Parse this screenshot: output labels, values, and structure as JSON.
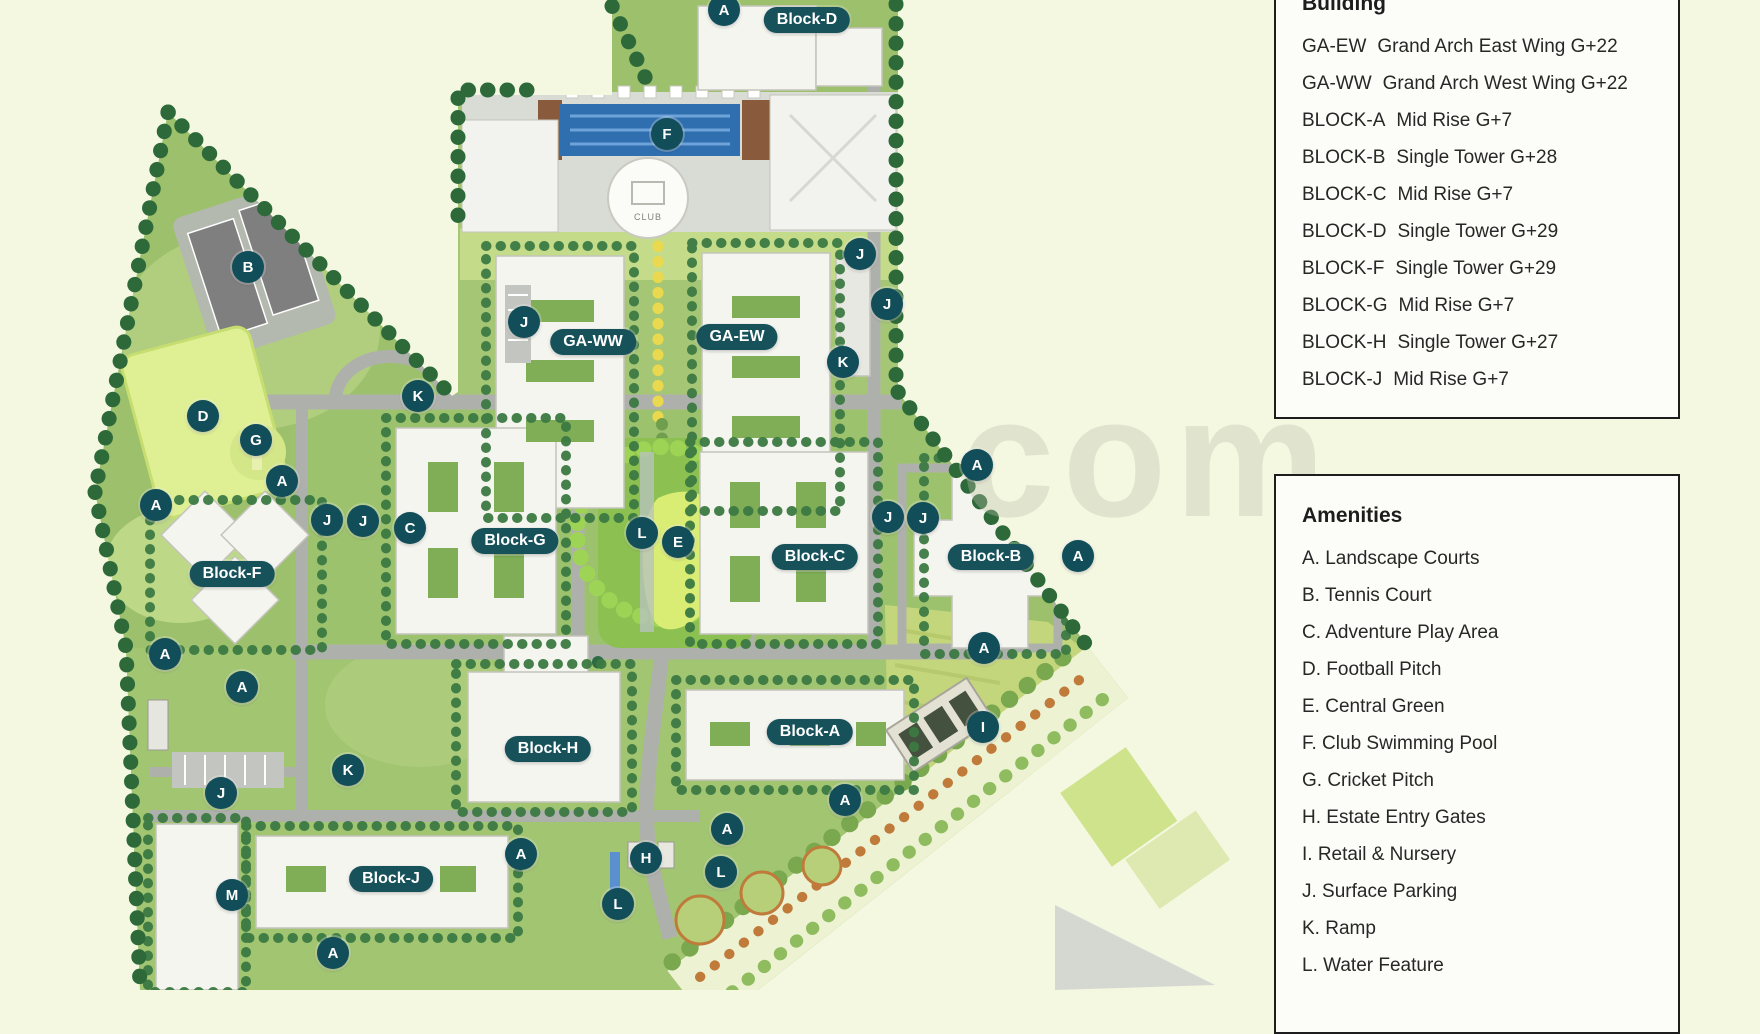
{
  "watermark": "com",
  "map": {
    "club_label": "CLUB",
    "markers": [
      {
        "letter": "A",
        "x": 724,
        "y": 10
      },
      {
        "letter": "F",
        "x": 667,
        "y": 134
      },
      {
        "letter": "B",
        "x": 248,
        "y": 267
      },
      {
        "letter": "J",
        "x": 860,
        "y": 254
      },
      {
        "letter": "J",
        "x": 887,
        "y": 304
      },
      {
        "letter": "K",
        "x": 843,
        "y": 362
      },
      {
        "letter": "J",
        "x": 524,
        "y": 322
      },
      {
        "letter": "K",
        "x": 418,
        "y": 396
      },
      {
        "letter": "D",
        "x": 203,
        "y": 416
      },
      {
        "letter": "G",
        "x": 256,
        "y": 440
      },
      {
        "letter": "A",
        "x": 282,
        "y": 481
      },
      {
        "letter": "A",
        "x": 156,
        "y": 505
      },
      {
        "letter": "J",
        "x": 327,
        "y": 520
      },
      {
        "letter": "J",
        "x": 363,
        "y": 521
      },
      {
        "letter": "C",
        "x": 410,
        "y": 528
      },
      {
        "letter": "L",
        "x": 642,
        "y": 533
      },
      {
        "letter": "E",
        "x": 678,
        "y": 542
      },
      {
        "letter": "J",
        "x": 888,
        "y": 517
      },
      {
        "letter": "J",
        "x": 923,
        "y": 518
      },
      {
        "letter": "A",
        "x": 977,
        "y": 465
      },
      {
        "letter": "A",
        "x": 1078,
        "y": 556
      },
      {
        "letter": "A",
        "x": 984,
        "y": 648
      },
      {
        "letter": "A",
        "x": 165,
        "y": 654
      },
      {
        "letter": "A",
        "x": 242,
        "y": 687
      },
      {
        "letter": "I",
        "x": 983,
        "y": 727
      },
      {
        "letter": "A",
        "x": 845,
        "y": 800
      },
      {
        "letter": "K",
        "x": 348,
        "y": 770
      },
      {
        "letter": "J",
        "x": 221,
        "y": 793
      },
      {
        "letter": "M",
        "x": 232,
        "y": 895
      },
      {
        "letter": "A",
        "x": 521,
        "y": 854
      },
      {
        "letter": "H",
        "x": 646,
        "y": 858
      },
      {
        "letter": "L",
        "x": 618,
        "y": 904
      },
      {
        "letter": "L",
        "x": 721,
        "y": 872
      },
      {
        "letter": "A",
        "x": 727,
        "y": 829
      },
      {
        "letter": "A",
        "x": 333,
        "y": 953
      }
    ],
    "block_labels": [
      {
        "text": "Block-D",
        "x": 807,
        "y": 20
      },
      {
        "text": "GA-WW",
        "x": 593,
        "y": 342
      },
      {
        "text": "GA-EW",
        "x": 737,
        "y": 337
      },
      {
        "text": "Block-G",
        "x": 515,
        "y": 541
      },
      {
        "text": "Block-C",
        "x": 815,
        "y": 557
      },
      {
        "text": "Block-B",
        "x": 991,
        "y": 557
      },
      {
        "text": "Block-F",
        "x": 232,
        "y": 574
      },
      {
        "text": "Block-H",
        "x": 548,
        "y": 749
      },
      {
        "text": "Block-A",
        "x": 810,
        "y": 732
      },
      {
        "text": "Block-J",
        "x": 391,
        "y": 879
      }
    ]
  },
  "legend_building": {
    "title": "Building",
    "items": [
      {
        "code": "GA-EW",
        "desc": "Grand Arch East Wing G+22"
      },
      {
        "code": "GA-WW",
        "desc": "Grand Arch West Wing G+22"
      },
      {
        "code": "BLOCK-A",
        "desc": "Mid Rise G+7"
      },
      {
        "code": "BLOCK-B",
        "desc": "Single Tower G+28"
      },
      {
        "code": "BLOCK-C",
        "desc": "Mid Rise G+7"
      },
      {
        "code": "BLOCK-D",
        "desc": "Single Tower G+29"
      },
      {
        "code": "BLOCK-F",
        "desc": "Single Tower G+29"
      },
      {
        "code": "BLOCK-G",
        "desc": "Mid Rise G+7"
      },
      {
        "code": "BLOCK-H",
        "desc": "Single Tower G+27"
      },
      {
        "code": "BLOCK-J",
        "desc": "Mid Rise G+7"
      }
    ]
  },
  "legend_amenities": {
    "title": "Amenities",
    "items": [
      "A. Landscape Courts",
      "B. Tennis Court",
      "C. Adventure Play Area",
      "D. Football Pitch",
      "E. Central Green",
      "F. Club Swimming Pool",
      "G. Cricket Pitch",
      "H. Estate Entry Gates",
      "I. Retail & Nursery",
      "J. Surface Parking",
      "K. Ramp",
      "L. Water Feature"
    ]
  },
  "colors": {
    "marker_teal": "#114e59",
    "pill_teal": "#17525b",
    "panel_border": "#1d1d1d",
    "background": "#f4f8e1"
  }
}
